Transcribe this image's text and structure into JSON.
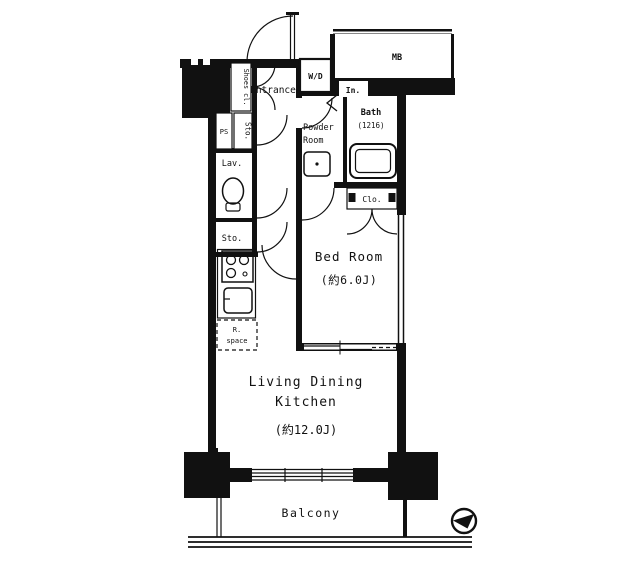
{
  "floor_plan": {
    "title": "1LDK apartment floor plan",
    "colors": {
      "wall": "#111111",
      "background": "#ffffff"
    },
    "rooms": {
      "entrance": {
        "label": "Entrance"
      },
      "shoes_closet": {
        "label": "Shoes cl."
      },
      "washer_dryer": {
        "label": "W/D"
      },
      "meter_box": {
        "label": "MB"
      },
      "inner_closet": {
        "label": "In."
      },
      "powder_room": {
        "label_line1": "Powder",
        "label_line2": "Room"
      },
      "bath": {
        "label": "Bath",
        "size": "(1216)"
      },
      "closet": {
        "label": "Clo."
      },
      "bedroom": {
        "label": "Bed Room",
        "size": "(約6.0J)"
      },
      "pipe_space": {
        "label": "PS"
      },
      "storage_upper": {
        "label": "Sto."
      },
      "lavatory": {
        "label": "Lav."
      },
      "storage_lower": {
        "label": "Sto."
      },
      "refrigerator_space": {
        "label_line1": "R.",
        "label_line2": "space"
      },
      "ldk": {
        "label_line1": "Living Dining",
        "label_line2": "Kitchen",
        "size": "(約12.0J)"
      },
      "balcony": {
        "label": "Balcony"
      }
    }
  }
}
